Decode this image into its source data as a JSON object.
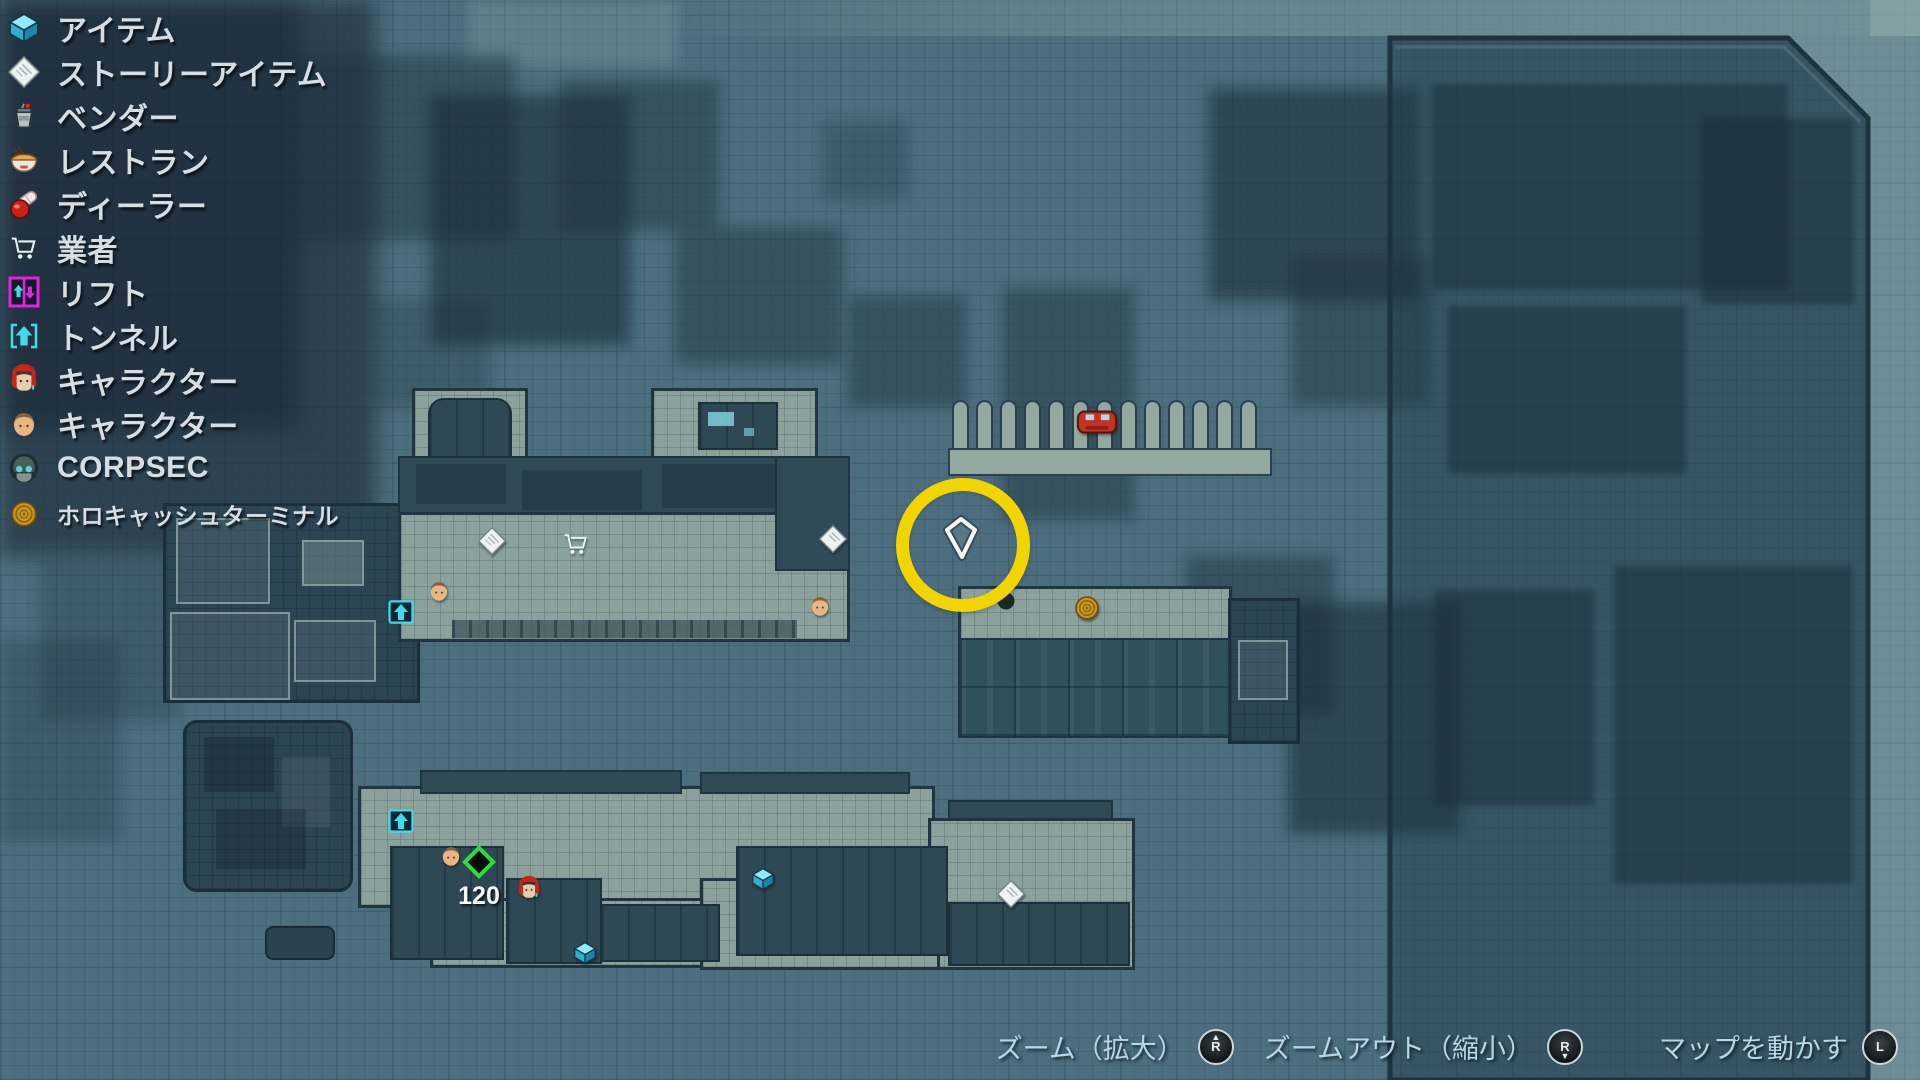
{
  "legend": {
    "items": [
      {
        "label": "アイテム",
        "icon": "item-box-icon"
      },
      {
        "label": "ストーリーアイテム",
        "icon": "story-item-icon"
      },
      {
        "label": "ベンダー",
        "icon": "vendor-icon"
      },
      {
        "label": "レストラン",
        "icon": "restaurant-icon"
      },
      {
        "label": "ディーラー",
        "icon": "dealer-icon"
      },
      {
        "label": "業者",
        "icon": "trader-cart-icon"
      },
      {
        "label": "リフト",
        "icon": "lift-icon"
      },
      {
        "label": "トンネル",
        "icon": "tunnel-icon"
      },
      {
        "label": "キャラクター",
        "icon": "character-female-icon"
      },
      {
        "label": "キャラクター",
        "icon": "character-male-icon"
      },
      {
        "label": "CORPSEC",
        "icon": "corpsec-icon"
      },
      {
        "label": "ホロキャッシュターミナル",
        "icon": "holocash-terminal-icon"
      }
    ]
  },
  "controls": {
    "zoom_in_label": "ズーム（拡大）",
    "zoom_out_label": "ズームアウト（縮小）",
    "move_map_label": "マップを動かす",
    "stick_r_letter": "R",
    "stick_l_letter": "L"
  },
  "map": {
    "objective_distance_label": "120",
    "highlight_ring_color": "#f2d400",
    "marker_types_present": [
      "waypoint-pin",
      "highlight-ring",
      "story-item",
      "trader-cart",
      "character-male",
      "character-female",
      "tunnel",
      "item-box",
      "objective-diamond",
      "holocash-terminal",
      "vehicle",
      "parking-stalls"
    ]
  }
}
